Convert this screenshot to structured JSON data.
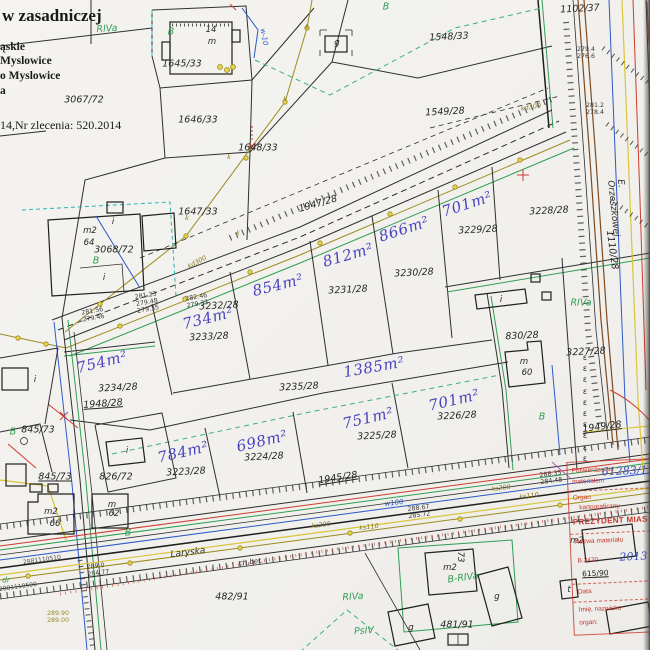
{
  "header": {
    "title": "w zasadniczej",
    "lines": [
      "ąskie",
      "Myslowice",
      "o Myslowice",
      "a",
      "14,Nr zlecenia: 520.2014"
    ]
  },
  "stamp": {
    "id_blue": "61283/1118",
    "l1": "Potwierdza się",
    "l2": "materiałem",
    "l3": "Organ",
    "l4": "kartograficzny",
    "l5": "PREZYDENT MIAS",
    "l6": "Nazwa materiału",
    "l7": "B.2470",
    "l7b": "2013",
    "l8": "615/90",
    "l9": "Data",
    "l10": "Imię, nazwisko",
    "l11": "organ:"
  },
  "colors": {
    "paper": "#f3f2ee",
    "line_black": "#2e2e2e",
    "landuse_green": "#2f9e55",
    "area_blue": "#4a43c0",
    "stamp_red": "#c4372e",
    "utility_olive": "#9b8b20",
    "water_blue": "#2b59c8",
    "road_brown": "#7a4a22",
    "teal": "#2ab5b5",
    "yellow": "#d9c53a",
    "hand_blue": "#3a50c0"
  },
  "map": {
    "labels": [
      {
        "t": "3067/72",
        "x": 84,
        "y": 100,
        "c": "parcel"
      },
      {
        "t": "1645/33",
        "x": 182,
        "y": 64,
        "c": "parcel"
      },
      {
        "t": "1646/33",
        "x": 198,
        "y": 120,
        "c": "parcel"
      },
      {
        "t": "1647/33",
        "x": 198,
        "y": 212,
        "c": "parcel"
      },
      {
        "t": "1648/33",
        "x": 258,
        "y": 148,
        "c": "parcel"
      },
      {
        "t": "1548/33",
        "x": 449,
        "y": 37,
        "r": -3,
        "c": "parcel"
      },
      {
        "t": "1549/28",
        "x": 445,
        "y": 112,
        "r": -3,
        "c": "parcel"
      },
      {
        "t": "1102/37",
        "x": 580,
        "y": 9,
        "r": -3,
        "c": "parcel"
      },
      {
        "t": "1947/28",
        "x": 318,
        "y": 204,
        "r": -16,
        "c": "parcel"
      },
      {
        "t": "3068/72",
        "x": 114,
        "y": 250,
        "c": "parcel"
      },
      {
        "t": "3233/28",
        "x": 209,
        "y": 337,
        "r": -3,
        "c": "parcel"
      },
      {
        "t": "3232/28",
        "x": 219,
        "y": 306,
        "r": -3,
        "c": "parcel"
      },
      {
        "t": "3231/28",
        "x": 348,
        "y": 290,
        "r": -3,
        "c": "parcel"
      },
      {
        "t": "3230/28",
        "x": 414,
        "y": 273,
        "r": -3,
        "c": "parcel"
      },
      {
        "t": "3229/28",
        "x": 478,
        "y": 230,
        "r": -3,
        "c": "parcel"
      },
      {
        "t": "3228/28",
        "x": 549,
        "y": 211,
        "r": -3,
        "c": "parcel"
      },
      {
        "t": "830/28",
        "x": 522,
        "y": 336,
        "r": -3,
        "c": "parcel"
      },
      {
        "t": "3227/28",
        "x": 586,
        "y": 352,
        "r": -3,
        "c": "parcel"
      },
      {
        "t": "3234/28",
        "x": 118,
        "y": 388,
        "r": -3,
        "c": "parcel"
      },
      {
        "t": "3235/28",
        "x": 299,
        "y": 387,
        "r": -3,
        "c": "parcel"
      },
      {
        "t": "3223/28",
        "x": 186,
        "y": 472,
        "r": -3,
        "c": "parcel"
      },
      {
        "t": "3224/28",
        "x": 264,
        "y": 457,
        "r": -3,
        "c": "parcel"
      },
      {
        "t": "3225/28",
        "x": 377,
        "y": 436,
        "r": -3,
        "c": "parcel"
      },
      {
        "t": "3226/28",
        "x": 457,
        "y": 416,
        "r": -3,
        "c": "parcel"
      },
      {
        "t": "845/73",
        "x": 38,
        "y": 430,
        "c": "parcel"
      },
      {
        "t": "845/73",
        "x": 55,
        "y": 477,
        "u": 1,
        "c": "parcel"
      },
      {
        "t": "826/72",
        "x": 116,
        "y": 477,
        "c": "parcel"
      },
      {
        "t": "1948/28",
        "x": 103,
        "y": 404,
        "r": -4,
        "u": 1,
        "c": "parcel"
      },
      {
        "t": "1945/28",
        "x": 338,
        "y": 478,
        "r": -9,
        "u": 1,
        "c": "parcel"
      },
      {
        "t": "1949/28",
        "x": 602,
        "y": 427,
        "r": -7,
        "u": 1,
        "c": "parcel"
      },
      {
        "t": "482/91",
        "x": 232,
        "y": 597,
        "c": "parcel"
      },
      {
        "t": "481/91",
        "x": 457,
        "y": 625,
        "c": "parcel"
      },
      {
        "t": "1110/28",
        "x": 612,
        "y": 250,
        "r": 82,
        "c": "parcel"
      },
      {
        "t": "754m²",
        "x": 102,
        "y": 362,
        "r": -14,
        "c": "area"
      },
      {
        "t": "734m²",
        "x": 208,
        "y": 318,
        "r": -14,
        "c": "area"
      },
      {
        "t": "854m²",
        "x": 278,
        "y": 285,
        "r": -14,
        "c": "area"
      },
      {
        "t": "812m²",
        "x": 348,
        "y": 255,
        "r": -16,
        "c": "area"
      },
      {
        "t": "866m²",
        "x": 404,
        "y": 229,
        "r": -18,
        "c": "area"
      },
      {
        "t": "701m²",
        "x": 467,
        "y": 204,
        "r": -18,
        "c": "area"
      },
      {
        "t": "1385m²",
        "x": 374,
        "y": 367,
        "r": -10,
        "c": "area"
      },
      {
        "t": "751m²",
        "x": 368,
        "y": 418,
        "r": -13,
        "c": "area"
      },
      {
        "t": "701m²",
        "x": 454,
        "y": 400,
        "r": -13,
        "c": "area"
      },
      {
        "t": "698m²",
        "x": 262,
        "y": 441,
        "r": -13,
        "c": "area"
      },
      {
        "t": "784m²",
        "x": 183,
        "y": 452,
        "r": -13,
        "c": "area"
      },
      {
        "t": "RIVa",
        "x": 107,
        "y": 29,
        "r": -4,
        "c": "green"
      },
      {
        "t": "B",
        "x": 171,
        "y": 32,
        "c": "green"
      },
      {
        "t": "B",
        "x": 386,
        "y": 7,
        "c": "green"
      },
      {
        "t": "B",
        "x": 96,
        "y": 261,
        "c": "green"
      },
      {
        "t": "B",
        "x": 13,
        "y": 432,
        "c": "green"
      },
      {
        "t": "B",
        "x": 128,
        "y": 533,
        "c": "green"
      },
      {
        "t": "B",
        "x": 542,
        "y": 417,
        "c": "green"
      },
      {
        "t": "RIVa",
        "x": 581,
        "y": 303,
        "c": "green"
      },
      {
        "t": "RIVa",
        "x": 353,
        "y": 597,
        "r": -4,
        "c": "green"
      },
      {
        "t": "PsIV",
        "x": 364,
        "y": 631,
        "r": -4,
        "c": "green"
      },
      {
        "t": "B-RIVa",
        "x": 463,
        "y": 578,
        "r": -8,
        "c": "green"
      },
      {
        "t": "dr",
        "x": 6,
        "y": 580,
        "c": "greens"
      },
      {
        "t": "Laryska",
        "x": 188,
        "y": 553,
        "r": -7,
        "c": "street"
      },
      {
        "t": "ch.bet.",
        "x": 251,
        "y": 562,
        "r": -7,
        "c": "small"
      },
      {
        "t": "E. Orzeszkowej",
        "x": 618,
        "y": 208,
        "r": 84,
        "c": "street"
      },
      {
        "t": "14",
        "x": 211,
        "y": 30,
        "c": "bld"
      },
      {
        "t": "m",
        "x": 212,
        "y": 42,
        "c": "bld"
      },
      {
        "t": "g",
        "x": 337,
        "y": 43,
        "c": "bld"
      },
      {
        "t": "m2",
        "x": 90,
        "y": 231,
        "c": "bld"
      },
      {
        "t": "64",
        "x": 89,
        "y": 243,
        "c": "bld"
      },
      {
        "t": "i",
        "x": 113,
        "y": 222,
        "c": "bld"
      },
      {
        "t": "i",
        "x": 104,
        "y": 278,
        "c": "bld"
      },
      {
        "t": "i",
        "x": 35,
        "y": 380,
        "c": "bld"
      },
      {
        "t": "i",
        "x": 127,
        "y": 451,
        "c": "bld"
      },
      {
        "t": "i",
        "x": 501,
        "y": 300,
        "c": "bld"
      },
      {
        "t": "m",
        "x": 524,
        "y": 362,
        "c": "bld"
      },
      {
        "t": "60",
        "x": 527,
        "y": 373,
        "c": "bld"
      },
      {
        "t": "m2",
        "x": 51,
        "y": 512,
        "c": "bld"
      },
      {
        "t": "66",
        "x": 55,
        "y": 524,
        "c": "bld"
      },
      {
        "t": "m",
        "x": 112,
        "y": 505,
        "c": "bld"
      },
      {
        "t": "62",
        "x": 114,
        "y": 514,
        "c": "bld"
      },
      {
        "t": "m2",
        "x": 450,
        "y": 568,
        "c": "bld"
      },
      {
        "t": "73",
        "x": 460,
        "y": 557,
        "r": 90,
        "c": "bld"
      },
      {
        "t": "g",
        "x": 497,
        "y": 597,
        "c": "bld"
      },
      {
        "t": "g",
        "x": 411,
        "y": 628,
        "c": "bld"
      },
      {
        "t": "m2",
        "x": 577,
        "y": 541,
        "c": "bld"
      },
      {
        "t": "t",
        "x": 569,
        "y": 590,
        "c": "bld"
      },
      {
        "t": "281.23\n279.48\n279.35",
        "x": 147,
        "y": 303,
        "r": -10,
        "c": "elev"
      },
      {
        "t": "281.56\n279.46",
        "x": 93,
        "y": 315,
        "r": -10,
        "c": "elev"
      },
      {
        "t": "282.46\n279.32",
        "x": 197,
        "y": 301,
        "r": -10,
        "c": "elev"
      },
      {
        "t": "281.2\n278.4",
        "x": 595,
        "y": 109,
        "c": "elev"
      },
      {
        "t": "279.4\n276.6",
        "x": 586,
        "y": 53,
        "c": "elev"
      },
      {
        "t": "288.67\n285.72",
        "x": 419,
        "y": 512,
        "r": -7,
        "c": "elev"
      },
      {
        "t": "289.0\n284.77",
        "x": 98,
        "y": 570,
        "r": -7,
        "c": "elev"
      },
      {
        "t": "288.35\n284.48",
        "x": 551,
        "y": 478,
        "r": -7,
        "c": "elev"
      },
      {
        "t": "289.90\n289.00",
        "x": 58,
        "y": 617,
        "c": "elevy"
      },
      {
        "t": "ks200",
        "x": 321,
        "y": 525,
        "r": -7,
        "c": "oliv"
      },
      {
        "t": "ks110",
        "x": 369,
        "y": 527,
        "r": -7,
        "c": "oliv"
      },
      {
        "t": "ks200",
        "x": 501,
        "y": 488,
        "r": -7,
        "c": "oliv"
      },
      {
        "t": "ks110",
        "x": 529,
        "y": 496,
        "r": -7,
        "c": "oliv"
      },
      {
        "t": "kd300",
        "x": 531,
        "y": 107,
        "r": -10,
        "c": "oliv"
      },
      {
        "t": "kd300",
        "x": 197,
        "y": 262,
        "r": -28,
        "c": "oliv"
      },
      {
        "t": "2881110510",
        "x": 42,
        "y": 560,
        "r": -8,
        "c": "tiny"
      },
      {
        "t": "2881110500",
        "x": 18,
        "y": 587,
        "r": -8,
        "c": "tiny"
      },
      {
        "t": "k",
        "x": 307,
        "y": 27,
        "c": "oliv"
      },
      {
        "t": "k",
        "x": 285,
        "y": 99,
        "c": "oliv"
      },
      {
        "t": "k",
        "x": 229,
        "y": 157,
        "c": "oliv"
      },
      {
        "t": "k",
        "x": 187,
        "y": 218,
        "c": "oliv"
      },
      {
        "t": "k",
        "x": 238,
        "y": 233,
        "c": "oliv"
      },
      {
        "t": "w-10",
        "x": 264,
        "y": 37,
        "r": 80,
        "c": "bluesm"
      },
      {
        "t": "w100",
        "x": 394,
        "y": 503,
        "r": -7,
        "c": "bluesm"
      },
      {
        "t": "ε\nε\nε\nε\nε\nε\nε\nε\nε\nε",
        "x": 585,
        "y": 408,
        "c": "eps"
      }
    ]
  }
}
